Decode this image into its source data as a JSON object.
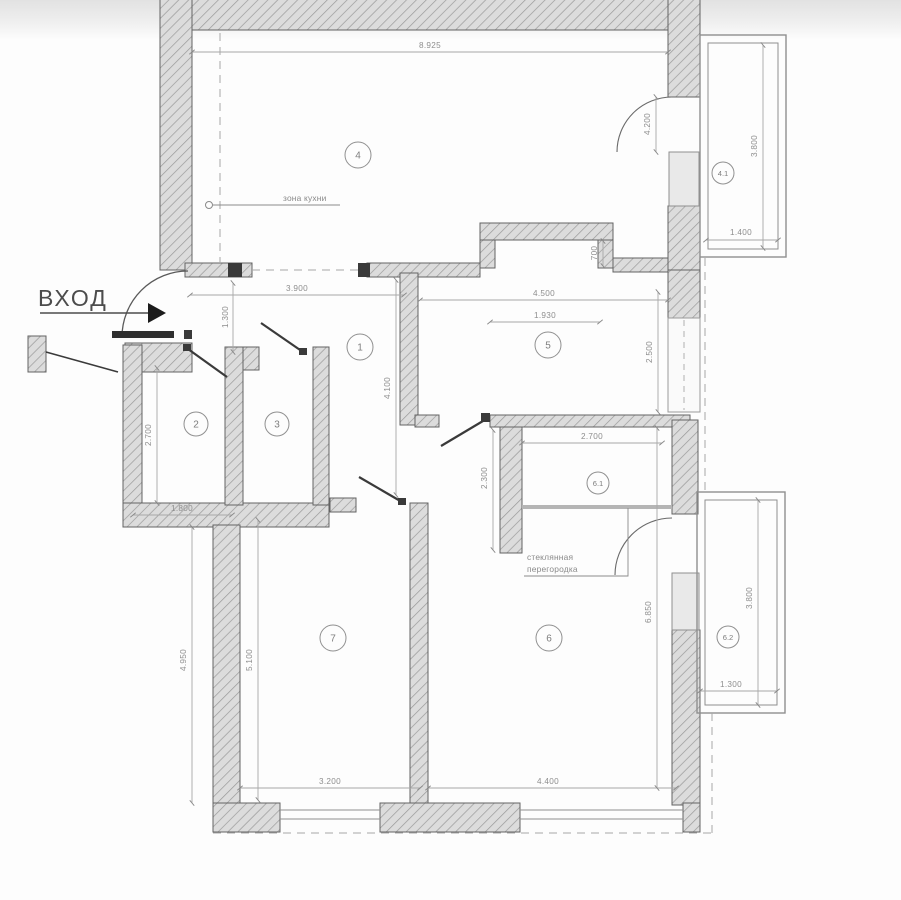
{
  "drawing": {
    "type": "apartment-floor-plan",
    "language": "ru"
  },
  "entrance": {
    "label": "ВХОД"
  },
  "annotations": {
    "kitchen_zone": "зона кухни",
    "glass_partition": [
      "стеклянная",
      "перегородка"
    ]
  },
  "rooms": {
    "r1": {
      "label": "1"
    },
    "r2": {
      "label": "2"
    },
    "r3": {
      "label": "3"
    },
    "r4": {
      "label": "4"
    },
    "r41": {
      "label": "4.1"
    },
    "r5": {
      "label": "5"
    },
    "r6": {
      "label": "6"
    },
    "r61": {
      "label": "6.1"
    },
    "r62": {
      "label": "6.2"
    },
    "r7": {
      "label": "7"
    }
  },
  "dimensions": {
    "top_width": "8.925",
    "hall_width": "3.900",
    "hall_depth": "1.300",
    "room5_width": "4.500",
    "niche_width": "1.930",
    "niche_depth": "700",
    "balcony41_door": "4.200",
    "balcony41_depth": "3.800",
    "balcony41_width": "1.400",
    "room5_depth": "2.500",
    "corridor_depth": "4.100",
    "room2_depth": "2.700",
    "room2_width": "1.800",
    "room61_width": "2.700",
    "room61_depth": "2.300",
    "room7_depth_outer": "4.950",
    "room7_depth": "5.100",
    "room7_width": "3.200",
    "room6_width": "4.400",
    "room6_depth": "6.850",
    "balcony62_depth": "3.800",
    "balcony62_width": "1.300"
  },
  "colors": {
    "wall_fill": "#dcdcdc",
    "wall_hatch": "#9a9a9a",
    "wall_stroke": "#636363",
    "window_fill": "#e9e9e9",
    "dim_line": "#a0a0a0",
    "dim_text": "#8e8e8e",
    "door_line": "#3a3a3a"
  }
}
